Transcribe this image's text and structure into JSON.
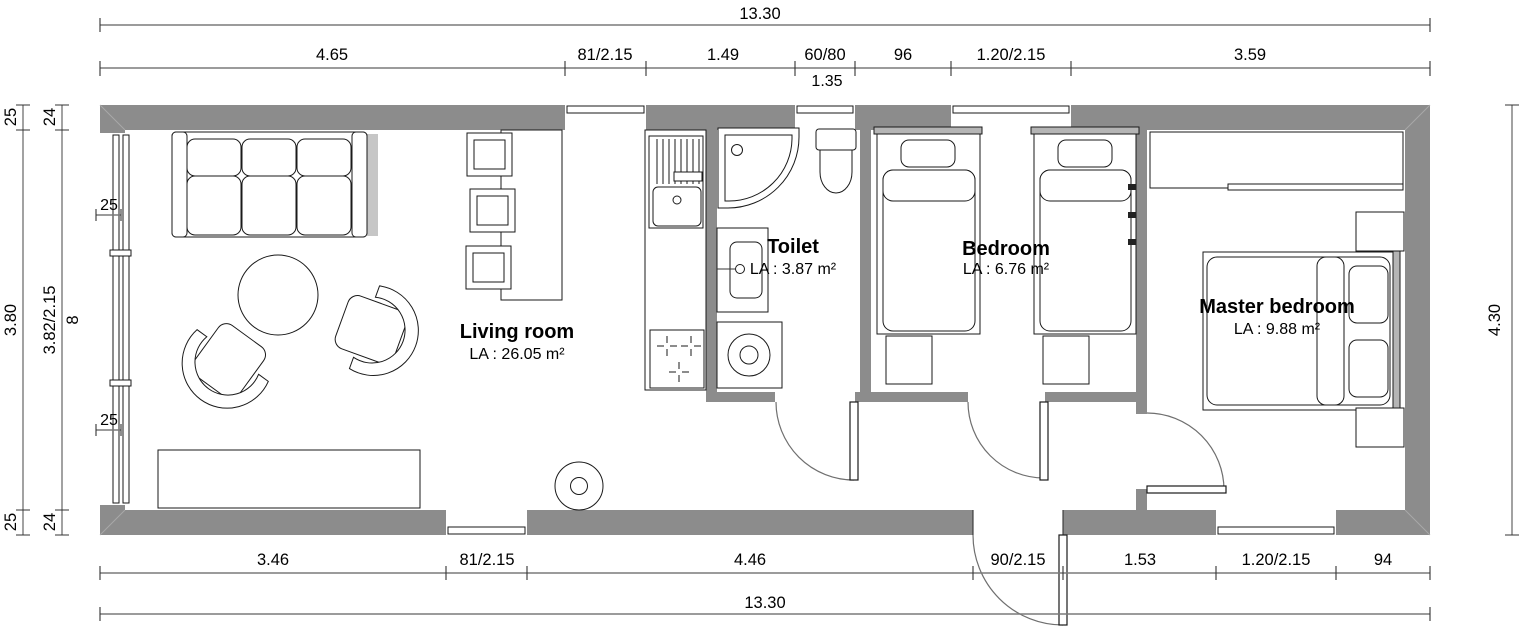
{
  "drawing": {
    "type": "floor-plan"
  },
  "colors": {
    "wall": "#8c8c8c",
    "line": "#1a1a1a",
    "dimension": "#7a7a7a",
    "background": "#ffffff"
  },
  "dimensions": {
    "top_overall": "13.30",
    "top_segments": [
      "4.65",
      "81/2.15",
      "1.49",
      "60/80",
      "96",
      "1.20/2.15",
      "3.59"
    ],
    "top_sub_label": "1.35",
    "left_outer": [
      "25",
      "3.80",
      "25"
    ],
    "left_inner": [
      "24",
      "3.82/2.15",
      "24"
    ],
    "left_inner_extra": "8",
    "left_wall_marks": [
      "25",
      "25"
    ],
    "right_overall": "4.30",
    "bottom_segments": [
      "3.46",
      "81/2.15",
      "4.46",
      "90/2.15",
      "1.53",
      "1.20/2.15",
      "94"
    ],
    "bottom_overall": "13.30"
  },
  "rooms": [
    {
      "name": "Living room",
      "area": "LA : 26.05 m²"
    },
    {
      "name": "Toilet",
      "area": "LA : 3.87 m²"
    },
    {
      "name": "Bedroom",
      "area": "LA : 6.76 m²"
    },
    {
      "name": "Master bedroom",
      "area": "LA : 9.88 m²"
    }
  ]
}
